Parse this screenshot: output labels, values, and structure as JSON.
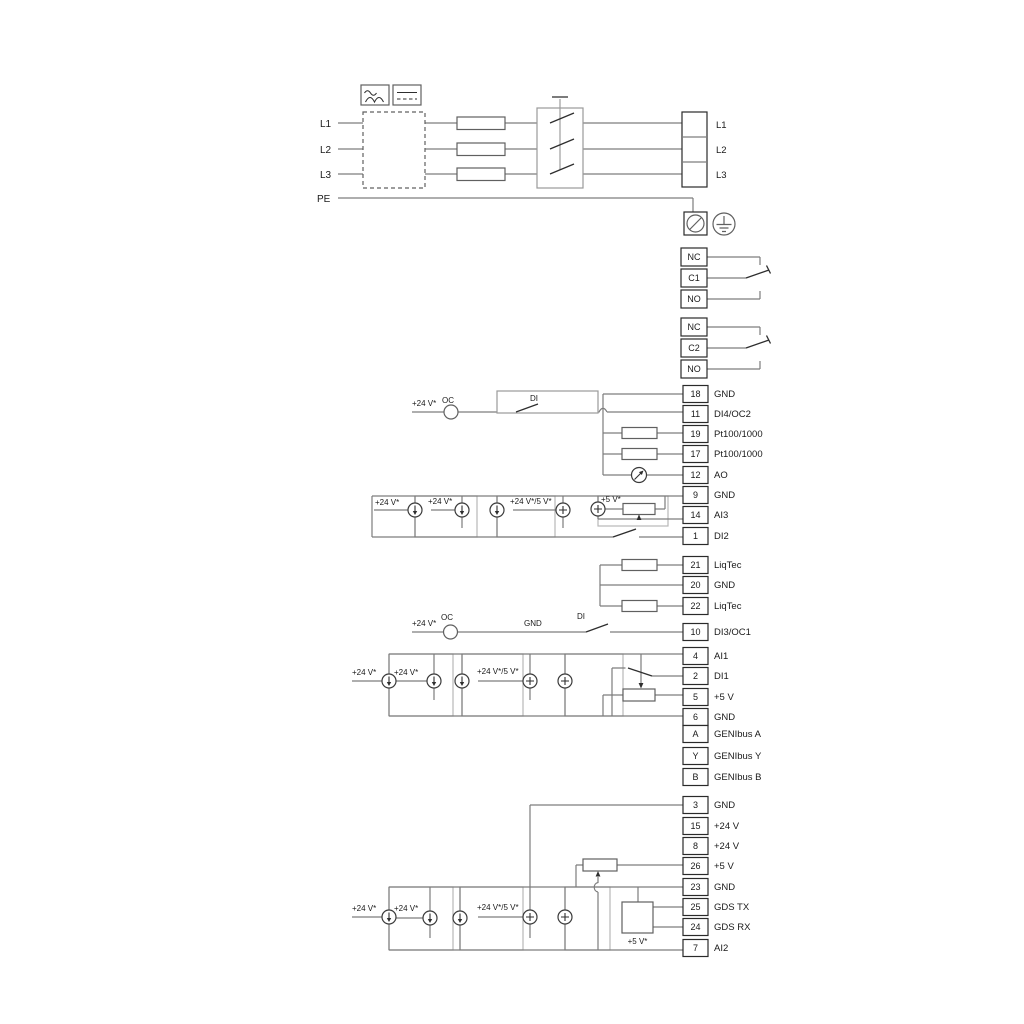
{
  "power": {
    "left_labels": [
      "L1",
      "L2",
      "L3",
      "PE"
    ],
    "right_labels": [
      "L1",
      "L2",
      "L3"
    ]
  },
  "relay1": [
    "NC",
    "C1",
    "NO"
  ],
  "relay2": [
    "NC",
    "C2",
    "NO"
  ],
  "io_block1": [
    {
      "num": "18",
      "label": "GND"
    },
    {
      "num": "11",
      "label": "DI4/OC2"
    },
    {
      "num": "19",
      "label": "Pt100/1000"
    },
    {
      "num": "17",
      "label": "Pt100/1000"
    },
    {
      "num": "12",
      "label": "AO"
    },
    {
      "num": "9",
      "label": "GND"
    },
    {
      "num": "14",
      "label": "AI3"
    },
    {
      "num": "1",
      "label": "DI2"
    }
  ],
  "liqtec_block": [
    {
      "num": "21",
      "label": "LiqTec"
    },
    {
      "num": "20",
      "label": "GND"
    },
    {
      "num": "22",
      "label": "LiqTec"
    }
  ],
  "io_block2": [
    {
      "num": "10",
      "label": "DI3/OC1"
    },
    {
      "num": "4",
      "label": "AI1"
    },
    {
      "num": "2",
      "label": "DI1"
    },
    {
      "num": "5",
      "label": "+5 V"
    },
    {
      "num": "6",
      "label": "GND"
    },
    {
      "num": "A",
      "label": "GENIbus A"
    },
    {
      "num": "Y",
      "label": "GENIbus Y"
    },
    {
      "num": "B",
      "label": "GENIbus B"
    }
  ],
  "io_block3": [
    {
      "num": "3",
      "label": "GND"
    },
    {
      "num": "15",
      "label": "+24 V"
    },
    {
      "num": "8",
      "label": "+24 V"
    },
    {
      "num": "26",
      "label": "+5 V"
    },
    {
      "num": "23",
      "label": "GND"
    },
    {
      "num": "25",
      "label": "GDS TX"
    },
    {
      "num": "24",
      "label": "GDS RX"
    },
    {
      "num": "7",
      "label": "AI2"
    }
  ],
  "annotations": {
    "v24": "+24 V*",
    "v24_5": "+24 V*/5 V*",
    "v5s": "+5 V*",
    "oc": "OC",
    "di": "DI",
    "gnd": "GND"
  },
  "colors": {
    "wire": "#7d7d7d",
    "component": "#606060",
    "terminal_border": "#2a2a2a",
    "text": "#1a1a1a",
    "background": "#ffffff"
  }
}
